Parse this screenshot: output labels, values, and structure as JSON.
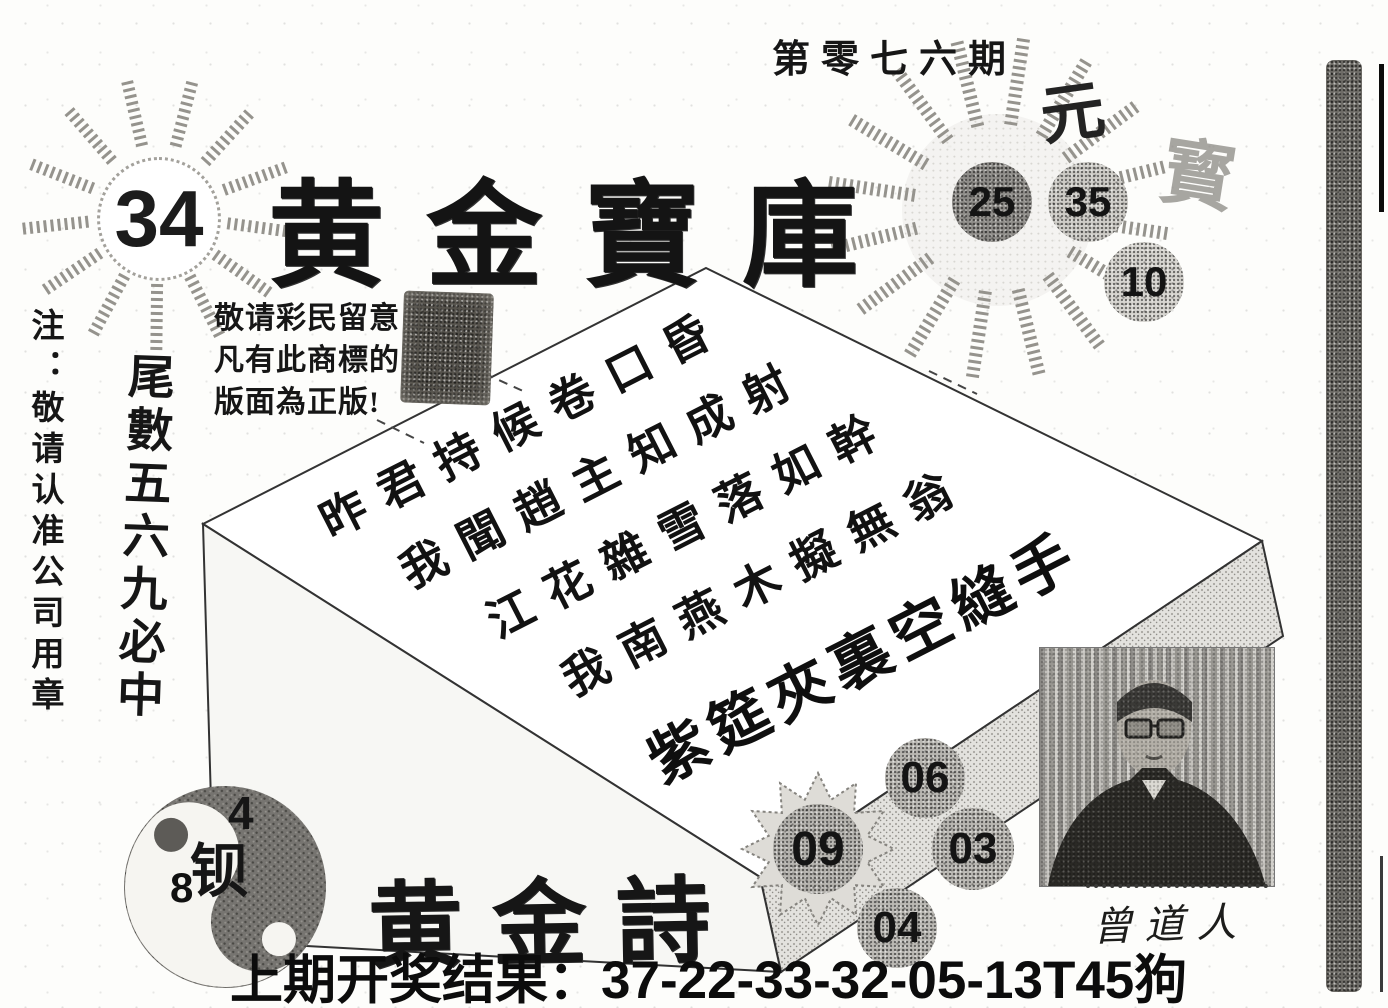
{
  "header": {
    "issue": "第零七六期"
  },
  "masthead": {
    "title": "黄金寶庫",
    "left_number": "34"
  },
  "right_sun": {
    "char_top": "元",
    "char_side": "寳",
    "balls": [
      "25",
      "35",
      "10"
    ]
  },
  "notice": {
    "side_vertical": "注：敬请认准公司用章",
    "trademark_lines": [
      "敬请彩民留意",
      "凡有此商標的",
      "版面為正版!"
    ],
    "tail_slogan": "尾數五六九必中"
  },
  "poem": {
    "lines": [
      "昨君持候卷口昏",
      "我聞趙主知成射",
      "江花雜雪落如幹",
      "我南燕木擬無翁"
    ],
    "side_line": "紫筵夾裏空縫手",
    "title": "黄金詩"
  },
  "picks": {
    "balls": [
      "06",
      "09",
      "03",
      "04"
    ]
  },
  "taiji": {
    "number_top": "4",
    "number_bottom": "8",
    "center_char": "钡"
  },
  "portrait": {
    "caption": "曾道人"
  },
  "footer": {
    "last_result": "上期开奖结果：37-22-33-32-05-13T45狗"
  },
  "colors": {
    "ink": "#161616",
    "grain_dark": "#6e6c67",
    "ball_gray": "#b9b7b2",
    "ball_dark": "#8e8c88"
  }
}
